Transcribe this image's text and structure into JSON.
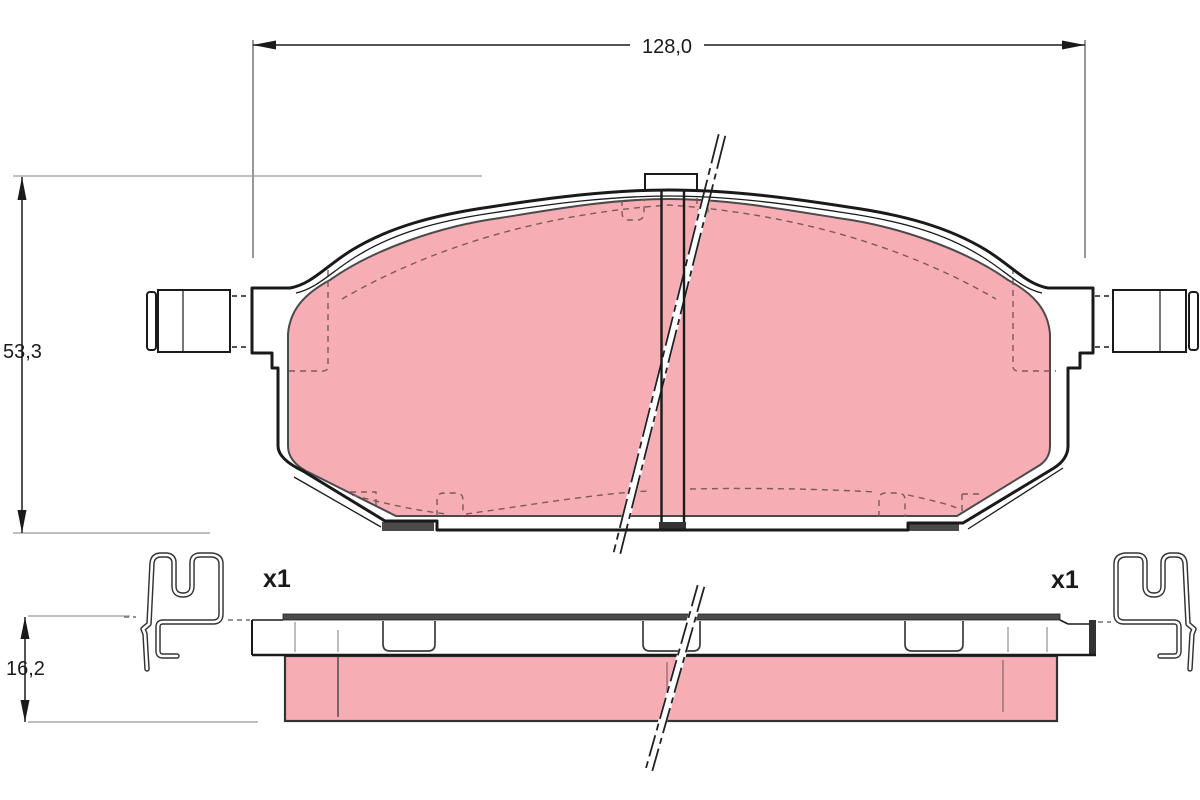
{
  "drawing": {
    "type": "brake-pad-technical-diagram",
    "dimensions": {
      "width_label": "128,0",
      "height_label": "53,3",
      "thickness_label": "16,2"
    },
    "accessories": {
      "left_clip_qty": "x1",
      "right_clip_qty": "x1"
    },
    "colors": {
      "friction": "#f7adb4",
      "outline": "#1a1a1a",
      "shade": "#4a4a4a",
      "dark_shade": "#333333",
      "ext_line": "#9a9a9a",
      "hidden_line": "#7a5a5a"
    }
  }
}
